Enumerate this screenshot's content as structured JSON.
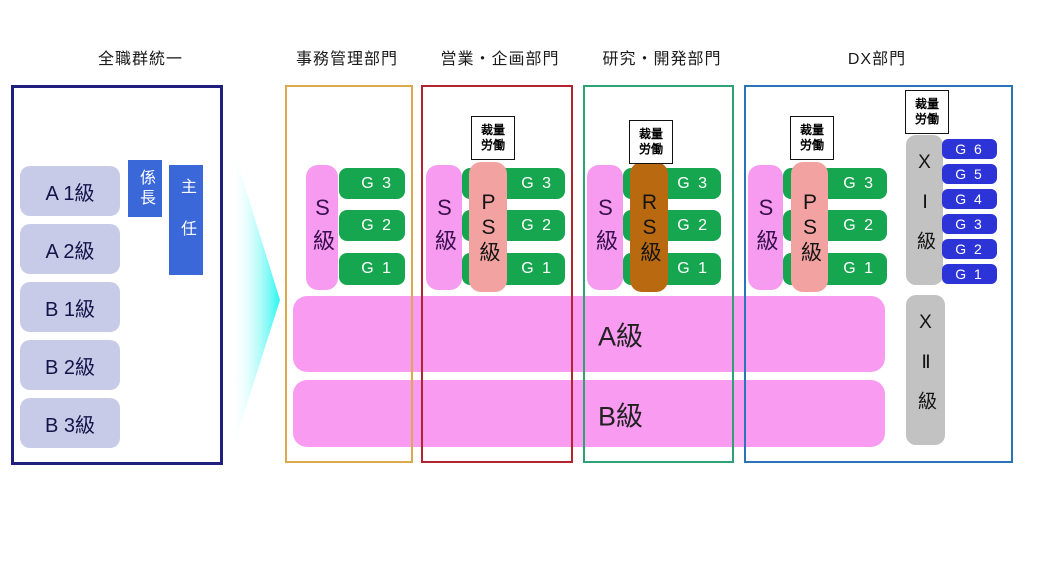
{
  "left_panel": {
    "title": "全職群統一",
    "levels": [
      "A 1級",
      "A 2級",
      "B 1級",
      "B 2級",
      "B 3級"
    ],
    "roles": [
      "係長",
      "主任"
    ]
  },
  "discretionary_label": "裁量\n労働",
  "departments": [
    {
      "name": "事務管理部門",
      "border_color": "#dca94e",
      "s_label": "S級",
      "grades": [
        "G 3",
        "G 2",
        "G 1"
      ]
    },
    {
      "name": "営業・企画部門",
      "border_color": "#b3242e",
      "s_label": "S級",
      "special_label": "PS級",
      "special_color": "#f2a3a1",
      "grades": [
        "G 3",
        "G 2",
        "G 1"
      ],
      "discretionary": true
    },
    {
      "name": "研究・開発部門",
      "border_color": "#2fa275",
      "s_label": "S級",
      "special_label": "RS級",
      "special_color": "#b96910",
      "grades": [
        "G 3",
        "G 2",
        "G 1"
      ],
      "discretionary": true
    },
    {
      "name": "DX部門",
      "border_color": "#2c74b8",
      "s_label": "S級",
      "special_label": "PS級",
      "special_color": "#f2a3a1",
      "grades": [
        "G 3",
        "G 2",
        "G 1"
      ],
      "discretionary": true,
      "dx_track": {
        "x1_label": "XⅠ級",
        "x2_label": "XⅡ級",
        "discretionary": true,
        "grades": [
          "G 6",
          "G 5",
          "G 4",
          "G 3",
          "G 2",
          "G 1"
        ]
      }
    }
  ],
  "bands": [
    "A級",
    "B級"
  ],
  "colors": {
    "left_border": "#1f1f7e",
    "level_box": "#c8cbe8",
    "role_blue": "#3a68d9",
    "arrow_cyan": "#2bf5f0",
    "s_pink": "#f79bf0",
    "band_pink": "#fa9bf2",
    "grade_green": "#17a650",
    "grade_blue": "#2c34d8",
    "gray_track": "#c2c2c2",
    "ps_salmon": "#f2a3a1",
    "rs_brown": "#b96910"
  }
}
